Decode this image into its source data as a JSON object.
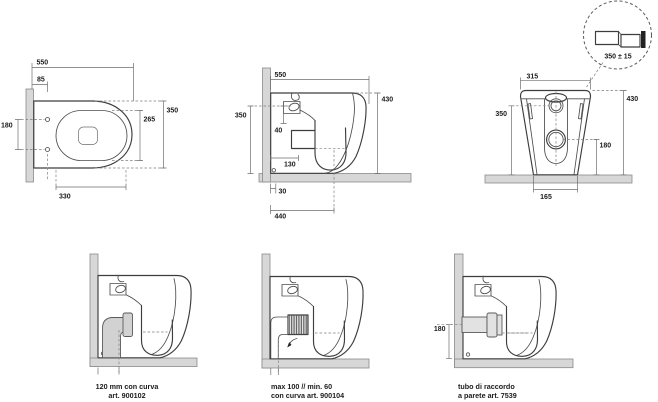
{
  "drawing": {
    "type": "sanitary-ware technical drawing, 6 views",
    "line_color": "#3d3d3d",
    "wall_fill": "#d7d7d7"
  },
  "views": {
    "plan": {
      "total_length": "550",
      "fixing_offset": "85",
      "fixing_spacing": "180",
      "total_width": "350",
      "bowl_width": "265",
      "bowl_length": "330"
    },
    "side": {
      "total_depth": "550",
      "total_height": "430",
      "inlet_height": "350",
      "inlet_drop": "40",
      "trap_offset": "130",
      "base_gap": "30",
      "outlet_distance": "440"
    },
    "rear": {
      "top_width": "315",
      "total_height": "430",
      "inlet_height": "350",
      "outlet_height": "180",
      "base_width": "165"
    },
    "detail": {
      "tolerance": "350 ± 15"
    },
    "outlets": {
      "floor": {
        "line1": "120 mm con curva",
        "line2": "art. 900102"
      },
      "offset": {
        "line1": "max 100 // min. 60",
        "line2": "con curva art. 900104"
      },
      "wall": {
        "outlet_height": "180",
        "line1": "tubo di raccordo",
        "line2": "a parete art. 7539"
      }
    }
  }
}
